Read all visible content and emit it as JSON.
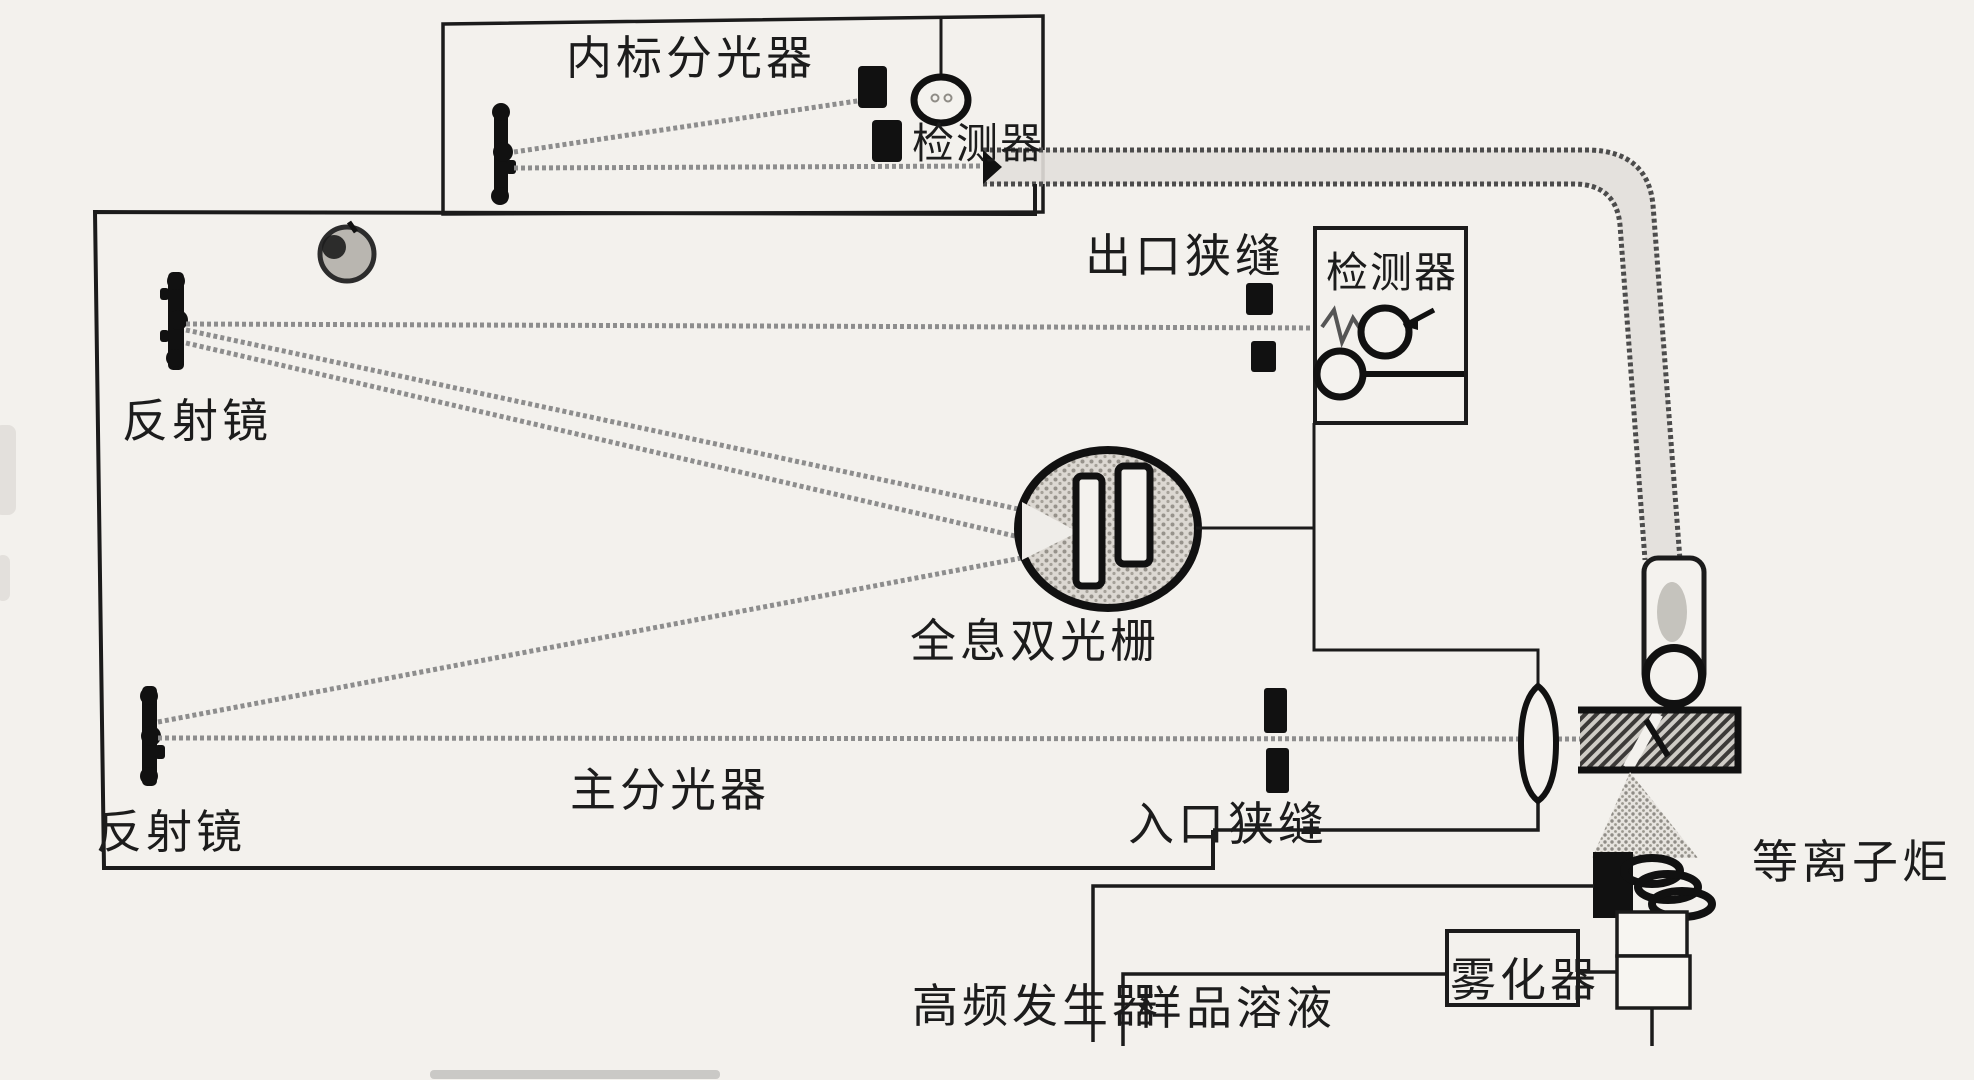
{
  "colors": {
    "paper": "#f3f1ed",
    "ink": "#1b1b1b",
    "beam_gray": "#8d8d8d",
    "pipe_fill": "#e2dfda",
    "grating_fill": "#dcd8d2"
  },
  "labels": {
    "internal_standard_spectrometer": "内标分光器",
    "detector_top": "检测器",
    "exit_slit": "出口狭缝",
    "detector_right": "检测器",
    "mirror_top": "反射镜",
    "mirror_bottom": "反射镜",
    "grating": "全息双光栅",
    "main_spectrometer": "主分光器",
    "entrance_slit": "入口狭缝",
    "plasma_torch": "等离子炬",
    "hf_generator": "高频发生器",
    "sample_solution": "样品溶液",
    "nebulizer": "雾化器"
  }
}
